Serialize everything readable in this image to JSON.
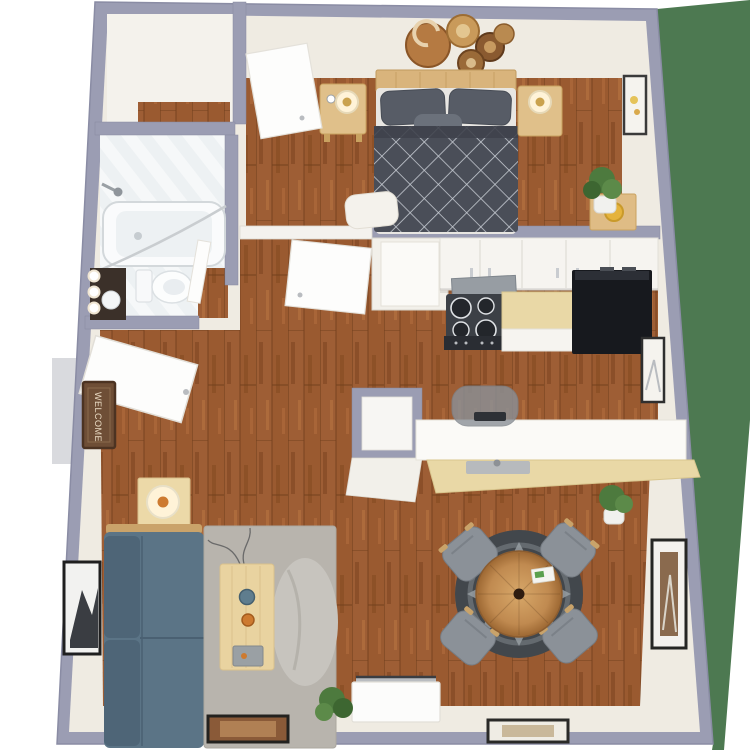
{
  "scene": {
    "type": "3d-floor-plan-render",
    "view": "top-down",
    "description": "One-bedroom apartment 3D floor plan with furniture",
    "doormat_text": "WELCOME"
  },
  "colors": {
    "page_bg": "#ffffff",
    "lawn": "#4d7951",
    "wall_outer": "#9b9db3",
    "wall_outer_dark": "#8a8ca4",
    "wall_inner": "#efebe2",
    "wall_white": "#f4f2ec",
    "floor_wood": "#9a5a30",
    "bath_tile": "#f6f8f9",
    "duvet": "#4a4e58",
    "pillow": "#575c66",
    "bed_frame": "#d9b47c",
    "night_wood": "#e0c08a",
    "sofa": "#5b7486",
    "sofa_dark": "#4e6577",
    "rug": "#b8b4ad",
    "beanbag": "#c7c4be",
    "table_pine": "#e9d3a0",
    "dining_rug": "#42474c",
    "chair": "#8b9198",
    "fridge": "#17191e",
    "stove": "#3c4046",
    "counter_tan": "#e9d8a6",
    "cabinet": "#f6f4f0",
    "hood": "#979da3",
    "plant": "#4d7a3e",
    "pot": "#f1f1ee",
    "mat": "#6e4e36",
    "frame": "#2b2b2b",
    "lamp_glow": "#fff3d8",
    "accent_orange": "#cd7a30"
  },
  "rooms": [
    {
      "name": "Walk-in Closet",
      "position": "top-left",
      "features": [
        "white floor",
        "wood threshold"
      ]
    },
    {
      "name": "Bathroom",
      "position": "left",
      "features": [
        "bathtub with shower head and curtain rod",
        "toilet",
        "dark vanity with sink and three round lights",
        "diagonal white tile floor"
      ]
    },
    {
      "name": "Bedroom",
      "position": "top",
      "features": [
        "bed with gray diamond-lattice duvet and gray pillows",
        "wood headboard",
        "two wood nightstands with lamps",
        "five round wall plates art",
        "bench at foot of bed",
        "potted plant",
        "side table with sun hat",
        "framed art on right wall",
        "open door"
      ]
    },
    {
      "name": "Hallway",
      "position": "center",
      "features": [
        "utility closet",
        "linen closet",
        "two open interior doors"
      ]
    },
    {
      "name": "Kitchen",
      "position": "right-center",
      "features": [
        "white upper cabinets",
        "range with gray hood and four burners",
        "tan countertop",
        "black refrigerator",
        "breakfast-bar peninsula with sink and faucet",
        "gray desk chair",
        "framed art"
      ]
    },
    {
      "name": "Entry",
      "position": "left",
      "features": [
        "open front door",
        "WELCOME doormat",
        "porch step outside"
      ]
    },
    {
      "name": "Living Room",
      "position": "bottom-left",
      "features": [
        "blue-gray sofa with wood trim",
        "gray area rug",
        "pine coffee table with speaker, bowl and remote",
        "beanbag chair",
        "side table with lamp",
        "white TV console with television",
        "green shrub",
        "two leaning framed pictures",
        "black-framed wall photo"
      ]
    },
    {
      "name": "Dining Area",
      "position": "bottom-right",
      "features": [
        "round wood dining table",
        "four gray chairs",
        "round charcoal rug with tribal pattern",
        "potted plant",
        "tall framed wall art"
      ]
    }
  ]
}
